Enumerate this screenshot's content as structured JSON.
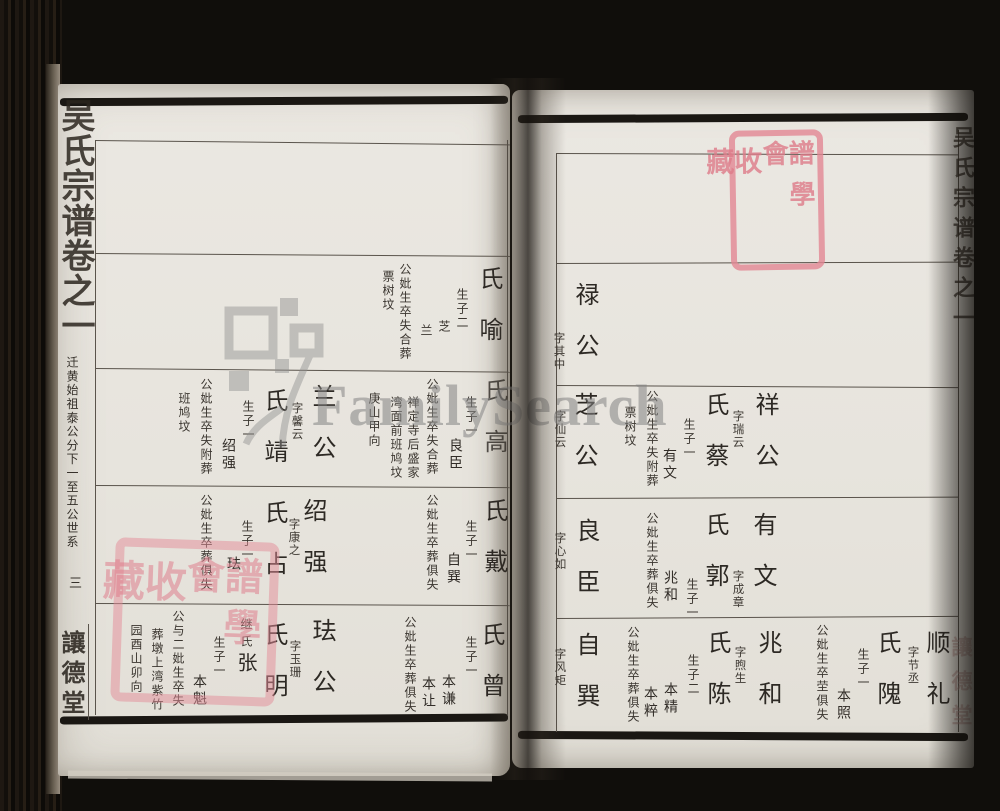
{
  "colors": {
    "page": "#e9e6df",
    "ink": "#332e29",
    "rule": "#5a544c",
    "seal_red": "#d9808e",
    "watermark_grey": "#848484"
  },
  "watermark": {
    "brand": "FamilySearch",
    "logo": "pedigree-squares-tree-logo"
  },
  "seal": {
    "col1": [
      "譜",
      "學",
      "會"
    ],
    "col2": [
      "收",
      "藏"
    ]
  },
  "left_page": {
    "spine_title": "吴氏宗谱卷之一",
    "margin_lineage": "迁黄始祖泰公分下一至五公世系",
    "folio_number": "三",
    "hall_name": "讓德堂",
    "b2": {
      "wife": "氏喻",
      "sons_note": "生子二",
      "son1": "芝",
      "son2": "兰",
      "burial1": "公妣生卒失合葬",
      "burial2": "票树坟"
    },
    "b3r": {
      "wife": "氏高",
      "sons_note": "生子一",
      "son1": "良臣",
      "burial1": "公妣生卒失合葬",
      "burial2": "禅定寺后盛家",
      "burial3": "湾面前班鸠坟",
      "burial4": "庚山甲向"
    },
    "b3l": {
      "name": "兰公",
      "courtesy": "字馨云",
      "wife": "氏靖",
      "sons_note": "生子一",
      "son1": "绍强",
      "burial1": "公妣生卒失附葬",
      "burial2": "班鸠坟"
    },
    "b4r": {
      "wife": "氏戴",
      "sons_note": "生子一",
      "son1": "自巽",
      "burial1": "公妣生卒葬俱失"
    },
    "b4l": {
      "name": "绍强",
      "courtesy": "字康之",
      "wife": "氏占",
      "sons_note": "生子一",
      "son1": "珐",
      "burial1": "公妣生卒葬俱失"
    },
    "b5r": {
      "wife": "氏曾",
      "sons_note": "生子一",
      "son1": "本谦",
      "son2": "本让",
      "burial1": "公妣生卒葬俱失"
    },
    "b5l": {
      "name": "珐公",
      "courtesy": "字玉珊",
      "wife": "氏明",
      "wife2a": "继氏",
      "wife2b": "张",
      "sons_note": "生子一",
      "son1": "本魁",
      "burial1": "公与二妣生卒失",
      "burial2": "葬墩上湾紫竹",
      "burial3": "园酉山卯向"
    }
  },
  "right_page": {
    "spine_title": "吴氏宗谱卷之一",
    "hall_name": "讓德堂",
    "r2": {
      "name": "禄公",
      "courtesy": "字其中"
    },
    "r3r": {
      "name": "祥公",
      "courtesy": "字瑞云",
      "wife": "氏蔡",
      "sons_note": "生子一",
      "son1": "有文",
      "burial1": "公妣生卒失附葬",
      "burial2": "票树坟"
    },
    "r3l": {
      "name": "芝公",
      "courtesy": "字仙云"
    },
    "r4r": {
      "name": "有文",
      "courtesy": "字成章",
      "wife": "氏郭",
      "sons_note": "生子一",
      "son1": "兆和",
      "burial1": "公妣生卒葬俱失"
    },
    "r4l": {
      "name": "良臣",
      "courtesy": "字心如"
    },
    "r5a": {
      "name": "顺礼",
      "courtesy": "字节丞",
      "wife": "氏隗",
      "sons_note": "生子一",
      "son1": "本照",
      "burial1": "公妣生卒茔俱失"
    },
    "r5b": {
      "name": "兆和",
      "courtesy": "字煦生",
      "wife": "氏陈",
      "sons_note": "生子二",
      "son1": "本精",
      "son2": "本粹",
      "burial1": "公妣生卒葬俱失"
    },
    "r5c": {
      "name": "自巽",
      "courtesy": "字风矩"
    }
  }
}
